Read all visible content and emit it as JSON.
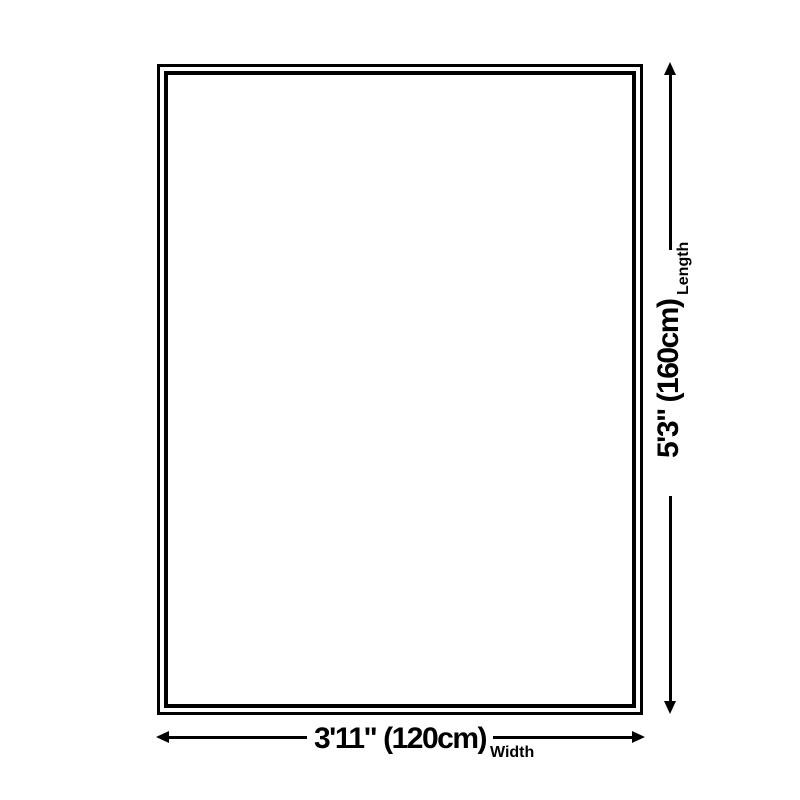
{
  "colors": {
    "background": "#ffffff",
    "line": "#000000"
  },
  "dimensions": {
    "length": {
      "value": "5'3\" (160cm)",
      "axis_label": "Length"
    },
    "width": {
      "value": "3'11\" (120cm)",
      "axis_label": "Width"
    }
  }
}
